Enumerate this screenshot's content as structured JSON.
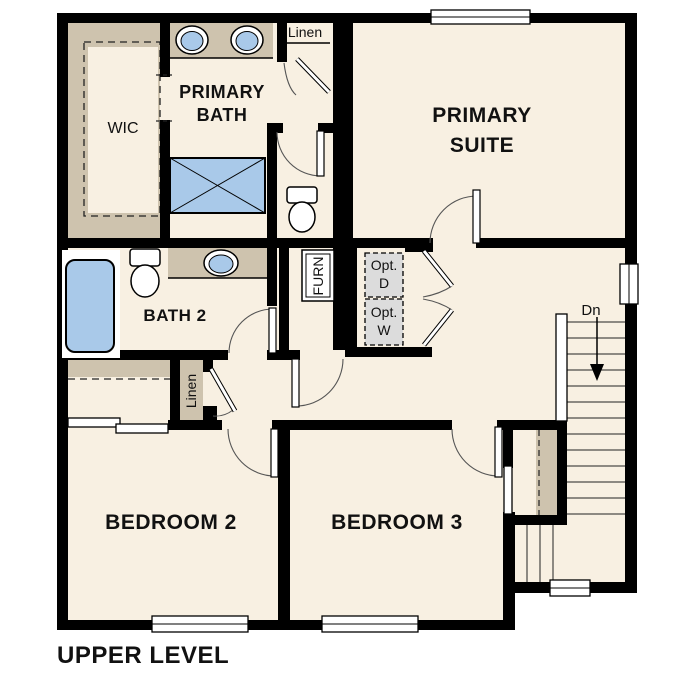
{
  "plan": {
    "title": "UPPER LEVEL",
    "rooms": {
      "wic": "WIC",
      "primary_bath_line1": "PRIMARY",
      "primary_bath_line2": "BATH",
      "primary_suite_line1": "PRIMARY",
      "primary_suite_line2": "SUITE",
      "bath2": "BATH 2",
      "bedroom2": "BEDROOM 2",
      "bedroom3": "BEDROOM 3"
    },
    "closets": {
      "linen_upper": "Linen",
      "linen_hall": "Linen"
    },
    "utility": {
      "furnace": "FURN",
      "opt_dryer_line1": "Opt.",
      "opt_dryer_line2": "D",
      "opt_washer_line1": "Opt.",
      "opt_washer_line2": "W"
    },
    "stairs": {
      "down_label": "Dn"
    },
    "colors": {
      "floor": "#f8f0e2",
      "wall": "#000000",
      "casework_tan": "#cec3ae",
      "fixture_blue": "#a9c9e9",
      "optional_gray": "#dcdcdc"
    }
  }
}
